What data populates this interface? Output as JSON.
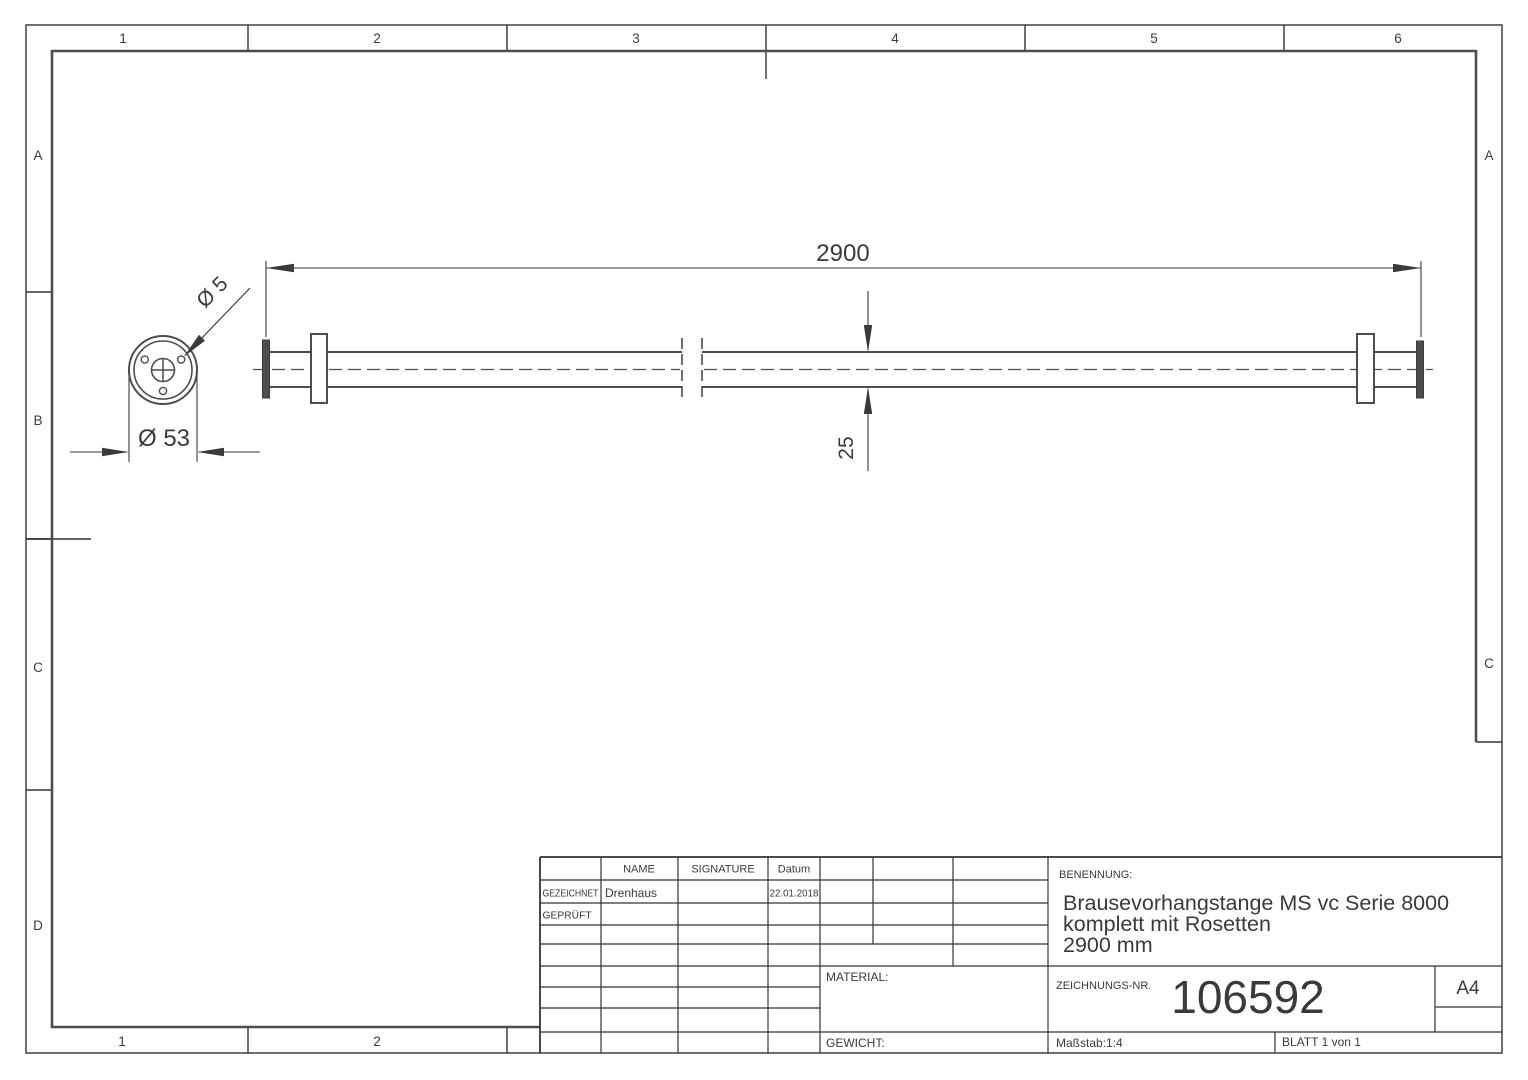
{
  "sheet": {
    "paper_format": "A4",
    "zones": {
      "top": [
        "1",
        "2",
        "3",
        "4",
        "5",
        "6"
      ],
      "bottom": [
        "1",
        "2"
      ],
      "left": [
        "A",
        "B",
        "C",
        "D"
      ],
      "right": [
        "A",
        "C"
      ]
    }
  },
  "drawing": {
    "dim_length": "2900",
    "dim_rod_dia": "25",
    "dim_rosette_dia": "Ø 53",
    "dim_hole_dia": "Ø 5"
  },
  "title_block": {
    "col_headers": {
      "name": "NAME",
      "signature": "SIGNATURE",
      "date": "Datum"
    },
    "row_drawn": {
      "label": "GEZEICHNET",
      "name": "Drenhaus",
      "date": "22.01.2018"
    },
    "row_checked": {
      "label": "GEPRÜFT"
    },
    "material_label": "MATERIAL:",
    "weight_label": "GEWICHT:",
    "benennung_label": "BENENNUNG:",
    "title_lines": [
      "Brausevorhangstange MS vc Serie 8000",
      "komplett mit Rosetten",
      "2900 mm"
    ],
    "drawing_no_label": "ZEICHNUNGS-NR.",
    "drawing_no": "106592",
    "paper": "A4",
    "scale": "Maßstab:1:4",
    "sheet_info": "BLATT 1 von 1"
  },
  "colors": {
    "object_line": "#4d4d4d",
    "thin_line": "#3a3a3a",
    "border": "#333333"
  }
}
